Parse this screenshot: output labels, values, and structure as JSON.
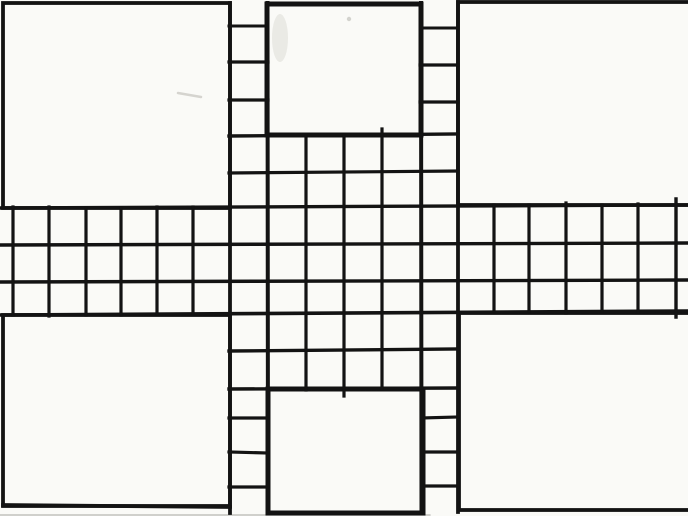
{
  "canvas": {
    "width": 688,
    "height": 516,
    "background": "#fafaf7",
    "ink_color": "#131313",
    "pencil_color": "#b8b6b0"
  },
  "board": {
    "panels": [
      {
        "name": "top-left-panel",
        "x": 3,
        "y": 3,
        "w": 227,
        "h": 205,
        "stroke": 3.8
      },
      {
        "name": "top-right-panel",
        "x": 458,
        "y": 2,
        "w": 234,
        "h": 203,
        "stroke": 3.8
      },
      {
        "name": "bottom-left-panel",
        "x": 3,
        "y": 315,
        "w": 227,
        "h": 191,
        "stroke": 3.8
      },
      {
        "name": "bottom-right-panel",
        "x": 459,
        "y": 313,
        "w": 233,
        "h": 197,
        "stroke": 3.8
      },
      {
        "name": "top-home-box",
        "x": 267,
        "y": 4,
        "w": 154,
        "h": 131,
        "stroke": 5
      },
      {
        "name": "bottom-home-box",
        "x": 268,
        "y": 389,
        "w": 155,
        "h": 124,
        "stroke": 5
      }
    ],
    "lines": [
      {
        "name": "band-row-line-1",
        "x1": 0,
        "y1": 208,
        "x2": 688,
        "y2": 205,
        "w": 3.4
      },
      {
        "name": "band-row-line-2",
        "x1": 0,
        "y1": 245,
        "x2": 688,
        "y2": 243,
        "w": 3.4
      },
      {
        "name": "band-row-line-3",
        "x1": 0,
        "y1": 282,
        "x2": 688,
        "y2": 280,
        "w": 3.4
      },
      {
        "name": "band-row-line-4",
        "x1": 0,
        "y1": 315,
        "x2": 688,
        "y2": 311,
        "w": 3.6
      },
      {
        "name": "center-grid-top-line",
        "x1": 229,
        "y1": 136,
        "x2": 458,
        "y2": 134,
        "w": 3.4
      },
      {
        "name": "center-grid-row-line-2",
        "x1": 229,
        "y1": 173,
        "x2": 458,
        "y2": 171,
        "w": 3.2
      },
      {
        "name": "center-grid-row-line-6",
        "x1": 229,
        "y1": 351,
        "x2": 458,
        "y2": 349,
        "w": 3.4
      },
      {
        "name": "center-grid-bottom-line",
        "x1": 229,
        "y1": 389,
        "x2": 458,
        "y2": 388,
        "w": 3.4
      },
      {
        "name": "top-left-strip-divider-1",
        "x1": 229,
        "y1": 26,
        "x2": 268,
        "y2": 26,
        "w": 3
      },
      {
        "name": "top-left-strip-divider-2",
        "x1": 229,
        "y1": 62,
        "x2": 268,
        "y2": 62,
        "w": 3.2
      },
      {
        "name": "top-left-strip-divider-3",
        "x1": 229,
        "y1": 100,
        "x2": 268,
        "y2": 100,
        "w": 3.2
      },
      {
        "name": "top-right-strip-divider-1",
        "x1": 420,
        "y1": 28,
        "x2": 458,
        "y2": 28,
        "w": 3
      },
      {
        "name": "top-right-strip-divider-2",
        "x1": 420,
        "y1": 65,
        "x2": 458,
        "y2": 65,
        "w": 3.2
      },
      {
        "name": "top-right-strip-divider-3",
        "x1": 420,
        "y1": 102,
        "x2": 458,
        "y2": 102,
        "w": 3.2
      },
      {
        "name": "bottom-left-strip-divider-1",
        "x1": 229,
        "y1": 418,
        "x2": 268,
        "y2": 418,
        "w": 3.2
      },
      {
        "name": "bottom-left-strip-divider-2",
        "x1": 229,
        "y1": 452,
        "x2": 268,
        "y2": 453,
        "w": 3.2
      },
      {
        "name": "bottom-left-strip-divider-3",
        "x1": 229,
        "y1": 487,
        "x2": 268,
        "y2": 487,
        "w": 3.2
      },
      {
        "name": "bottom-right-strip-divider-1",
        "x1": 422,
        "y1": 418,
        "x2": 458,
        "y2": 417,
        "w": 3.2
      },
      {
        "name": "bottom-right-strip-divider-2",
        "x1": 422,
        "y1": 452,
        "x2": 458,
        "y2": 452,
        "w": 3.2
      },
      {
        "name": "bottom-right-strip-divider-3",
        "x1": 422,
        "y1": 486,
        "x2": 458,
        "y2": 486,
        "w": 3.2
      },
      {
        "name": "left-arm-col-line-0",
        "x1": 13,
        "y1": 207,
        "x2": 13,
        "y2": 315,
        "w": 3.2
      },
      {
        "name": "left-arm-col-line-1",
        "x1": 49,
        "y1": 207,
        "x2": 49,
        "y2": 316,
        "w": 3.2
      },
      {
        "name": "left-arm-col-line-2",
        "x1": 86,
        "y1": 208,
        "x2": 86,
        "y2": 315,
        "w": 3.2
      },
      {
        "name": "left-arm-col-line-3",
        "x1": 121,
        "y1": 208,
        "x2": 121,
        "y2": 315,
        "w": 3.2
      },
      {
        "name": "left-arm-col-line-4",
        "x1": 157,
        "y1": 207,
        "x2": 157,
        "y2": 314,
        "w": 3.2
      },
      {
        "name": "left-arm-col-line-5",
        "x1": 193,
        "y1": 207,
        "x2": 193,
        "y2": 314,
        "w": 3.2
      },
      {
        "name": "center-col-line-230",
        "x1": 230,
        "y1": 3,
        "x2": 230,
        "y2": 513,
        "w": 3.8
      },
      {
        "name": "center-col-line-268",
        "x1": 267.5,
        "y1": 3,
        "x2": 268,
        "y2": 513,
        "w": 4
      },
      {
        "name": "center-col-line-306",
        "x1": 306,
        "y1": 135,
        "x2": 306,
        "y2": 390,
        "w": 3.2
      },
      {
        "name": "center-col-line-344",
        "x1": 344,
        "y1": 135,
        "x2": 344,
        "y2": 396,
        "w": 3.2
      },
      {
        "name": "center-col-line-382",
        "x1": 382,
        "y1": 129,
        "x2": 382,
        "y2": 389,
        "w": 3.2
      },
      {
        "name": "center-col-line-421",
        "x1": 421,
        "y1": 3,
        "x2": 421.5,
        "y2": 513,
        "w": 4
      },
      {
        "name": "center-col-line-458",
        "x1": 458,
        "y1": 2,
        "x2": 458,
        "y2": 512,
        "w": 3.8
      },
      {
        "name": "right-arm-col-line-1",
        "x1": 494,
        "y1": 205,
        "x2": 494,
        "y2": 311,
        "w": 3.2
      },
      {
        "name": "right-arm-col-line-2",
        "x1": 529,
        "y1": 205,
        "x2": 529,
        "y2": 311,
        "w": 3.2
      },
      {
        "name": "right-arm-col-line-3",
        "x1": 566,
        "y1": 203,
        "x2": 566,
        "y2": 313,
        "w": 3.2
      },
      {
        "name": "right-arm-col-line-4",
        "x1": 602,
        "y1": 205,
        "x2": 602,
        "y2": 311,
        "w": 3.2
      },
      {
        "name": "right-arm-col-line-5",
        "x1": 638,
        "y1": 204,
        "x2": 638,
        "y2": 312,
        "w": 3.2
      },
      {
        "name": "right-arm-col-line-6",
        "x1": 676,
        "y1": 199,
        "x2": 676,
        "y2": 317,
        "w": 3.4
      },
      {
        "name": "bottom-left-panel-bottom-line",
        "x1": 3,
        "y1": 505,
        "x2": 230,
        "y2": 507,
        "w": 3.8
      }
    ],
    "artifacts": [
      {
        "name": "pencil-smudge-top-left-panel",
        "type": "line",
        "x1": 178,
        "y1": 93,
        "x2": 201,
        "y2": 97,
        "w": 2.5,
        "color": "#b8b6b0",
        "opacity": 0.55
      },
      {
        "name": "pencil-scribble-top-home-box",
        "type": "ellipse",
        "cx": 280,
        "cy": 38,
        "rx": 8,
        "ry": 24,
        "color": "#e6e6e0",
        "opacity": 0.8
      },
      {
        "name": "pencil-dot-top-home-box",
        "type": "circle",
        "cx": 349,
        "cy": 19,
        "r": 2.2,
        "color": "#c9c9c3",
        "opacity": 0.8
      },
      {
        "name": "scan-shadow-bottom-edge",
        "type": "line",
        "x1": 0,
        "y1": 515,
        "x2": 430,
        "y2": 515,
        "w": 1.6,
        "color": "#8a8a86",
        "opacity": 0.5
      }
    ]
  }
}
